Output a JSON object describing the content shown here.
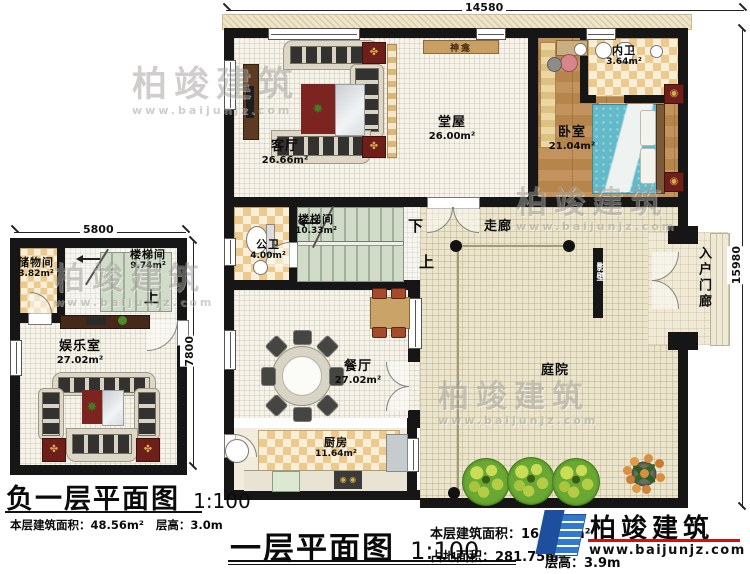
{
  "colors": {
    "wall": "#161616",
    "checker_tan": "#ecca8e",
    "wood_floor": "#b9854b",
    "bed_teal": "#64b9c8",
    "stair_green": "#d2dbca",
    "courtyard_cream": "#ebe5cd",
    "rug_red": "#7c241f",
    "tree_green": "#69a833",
    "logo_blue": "#2f7ad0",
    "logo_red_line": "#cc1111"
  },
  "first_floor": {
    "dims": {
      "width": "14580",
      "height": "15980"
    },
    "rooms": {
      "living": {
        "name": "客厅",
        "area": "26.66m²"
      },
      "hall": {
        "name": "堂屋",
        "area": "26.00m²"
      },
      "shrine": {
        "name": "神龛"
      },
      "bath_inner": {
        "name": "内卫",
        "area": "3.64m²"
      },
      "bedroom": {
        "name": "卧室",
        "area": "21.04m²"
      },
      "stairwell": {
        "name": "楼梯间",
        "area": "10.33m²"
      },
      "bath_public": {
        "name": "公卫",
        "area": "4.00m²"
      },
      "corridor": {
        "name": "走廊"
      },
      "dining": {
        "name": "餐厅",
        "area": "27.02m²"
      },
      "kitchen": {
        "name": "厨房",
        "area": "11.64m²"
      },
      "courtyard": {
        "name": "庭院"
      },
      "screen_wall": {
        "name": "影壁"
      },
      "entry_porch": {
        "name": "入户门廊"
      },
      "down": "下",
      "up": "上"
    },
    "title": {
      "name": "一层平面图",
      "scale": "1:100",
      "floor_area": "本层建筑面积：164.92m²",
      "site_area": "占地面积：281.75m²",
      "height": "层高：3.9m"
    }
  },
  "basement": {
    "dims": {
      "width": "5800",
      "height": "7800"
    },
    "rooms": {
      "storage": {
        "name": "储物间",
        "area": "3.82m²"
      },
      "stairwell": {
        "name": "楼梯间",
        "area": "9.74m²"
      },
      "recreation": {
        "name": "娱乐室",
        "area": "27.02m²"
      },
      "up": "上"
    },
    "title": {
      "name": "负一层平面图",
      "scale": "1:100",
      "floor_area": "本层建筑面积：48.56m²",
      "height": "层高：3.0m"
    }
  },
  "logo": {
    "name": "柏竣建筑",
    "url": "www.baijunjz.com"
  },
  "watermark": {
    "name": "柏竣建筑",
    "url": "www.baijunjz.com"
  }
}
